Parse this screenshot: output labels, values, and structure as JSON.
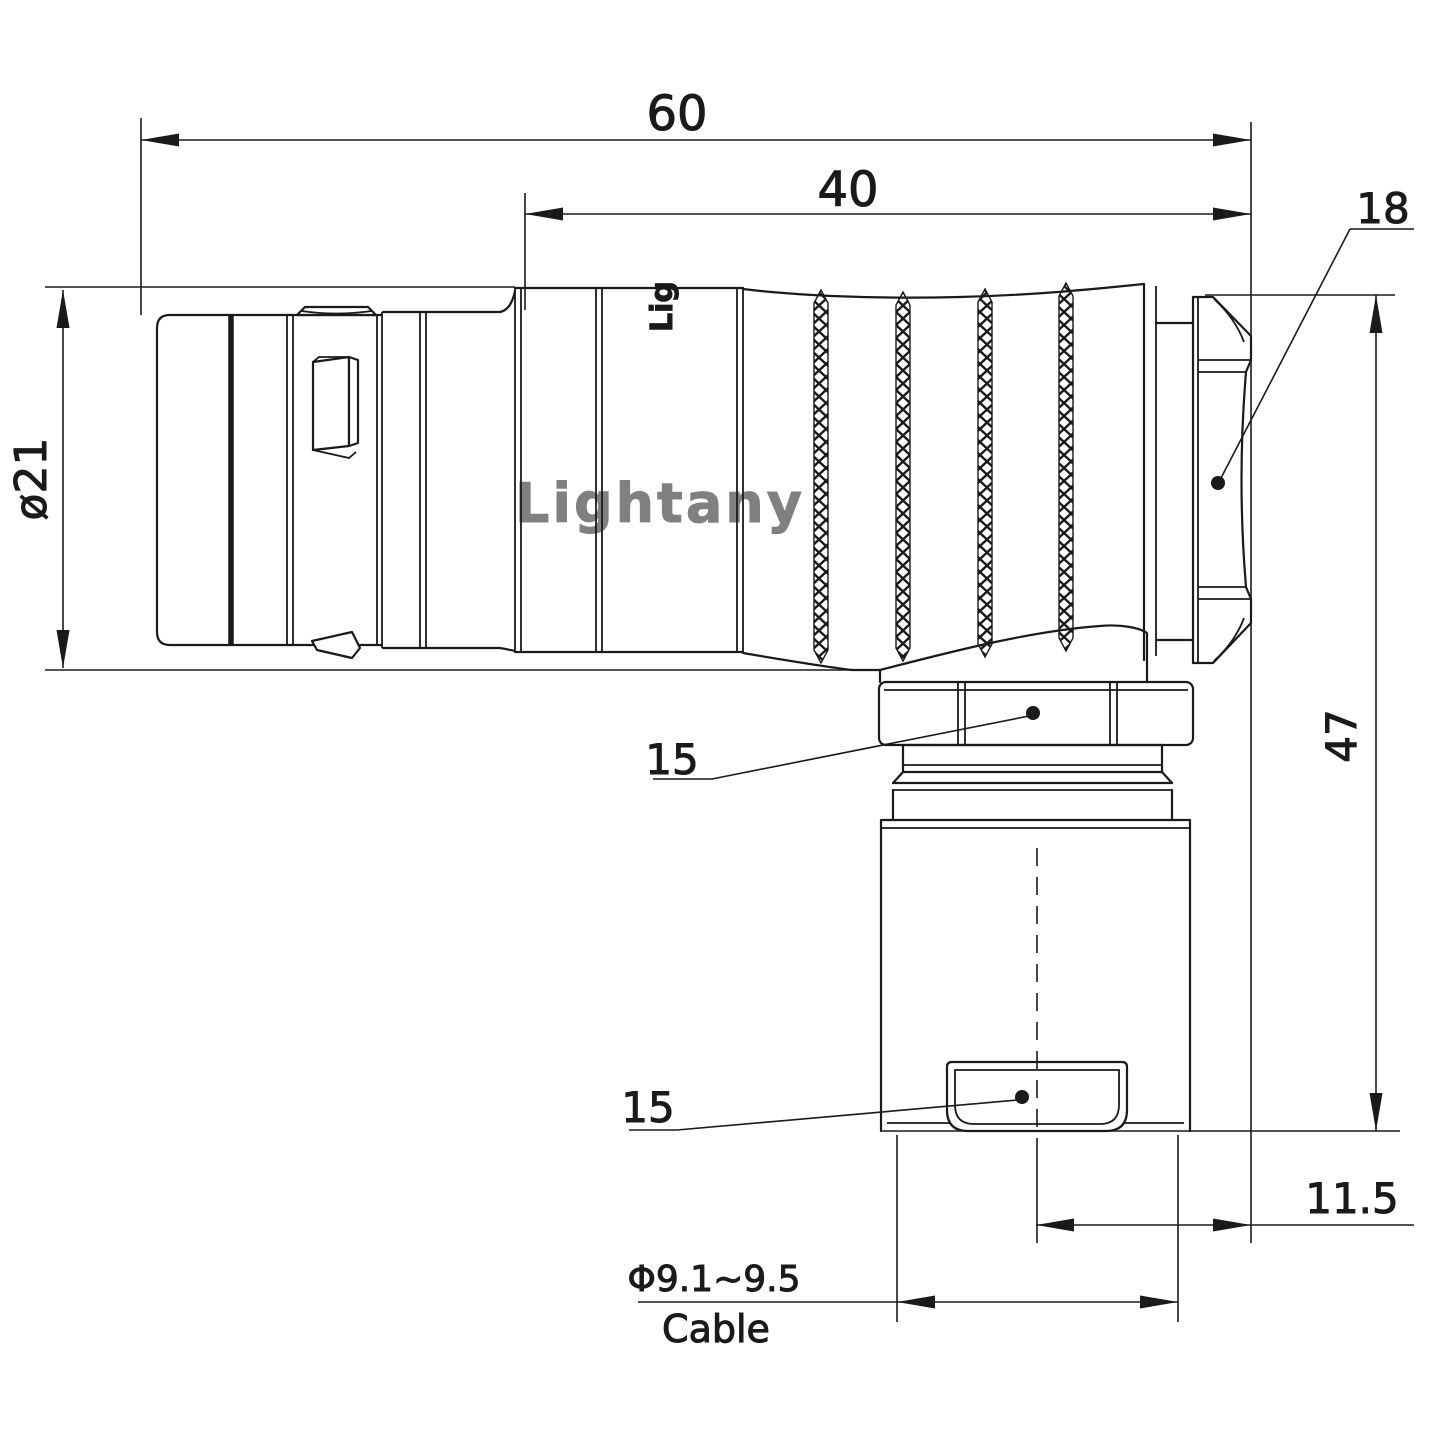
{
  "watermark": {
    "text": "Lightany",
    "color": "#f5bfbf"
  },
  "body_logo": {
    "text": "Lig"
  },
  "colors": {
    "line": "#1a1a1a",
    "background": "#ffffff"
  },
  "dims": {
    "overall_length": "60",
    "rear_section_length": "40",
    "back_nut_width": "18",
    "shell_diameter": "ø21",
    "elbow_height": "47",
    "coupling_nut_size": "15",
    "bushing_size": "15",
    "axis_offset": "11.5",
    "cable_range": "Φ9.1~9.5",
    "cable_label": "Cable"
  }
}
